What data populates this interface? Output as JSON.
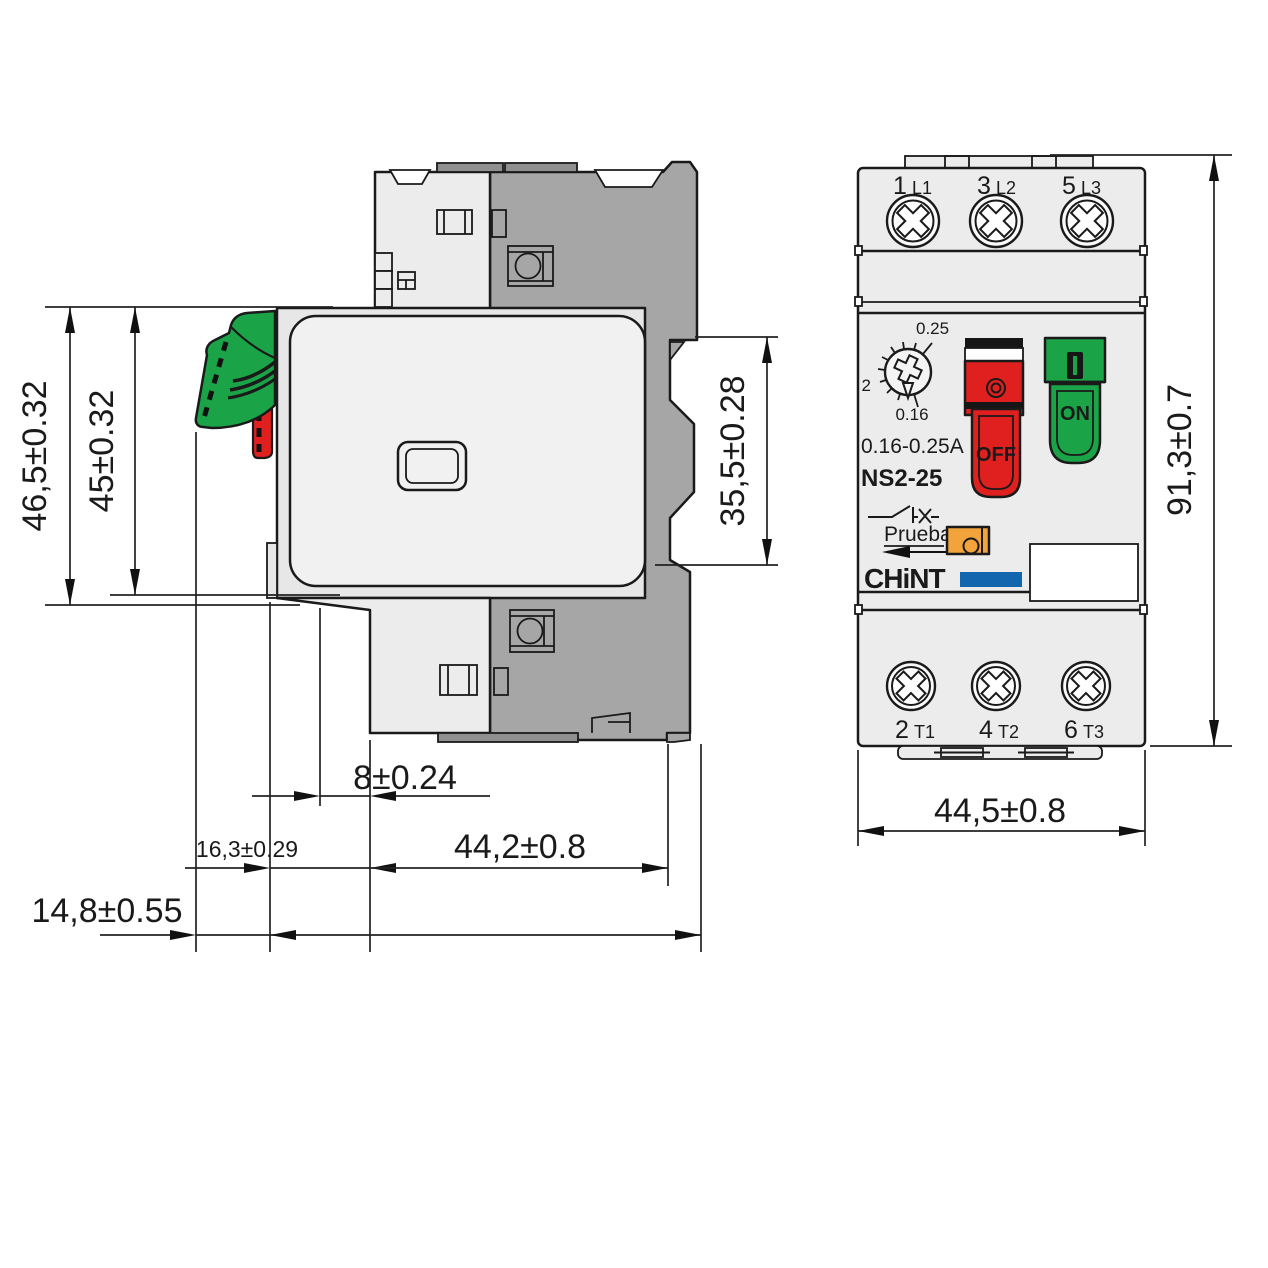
{
  "title": "NS2-25 motor starter dimensional drawing",
  "side_view": {
    "dim_height_outer": "46,5±0.32",
    "dim_height_inner": "45±0.32",
    "dim_rail_cutout": "35,5±0.28",
    "dim_step": "8±0.24",
    "dim_lever": "16,3±0.29",
    "dim_body_depth": "44,2±0.8",
    "dim_lever_offset": "14,8±0.55"
  },
  "front_view": {
    "dim_height": "91,3±0.7",
    "dim_width": "44,5±0.8",
    "terminals_top": [
      {
        "num": "1",
        "label": "L1"
      },
      {
        "num": "3",
        "label": "L2"
      },
      {
        "num": "5",
        "label": "L3"
      }
    ],
    "terminals_bottom": [
      {
        "num": "2",
        "label": "T1"
      },
      {
        "num": "4",
        "label": "T2"
      },
      {
        "num": "6",
        "label": "T3"
      }
    ],
    "dial": {
      "max": "0.25",
      "mid": "2",
      "min": "0.16"
    },
    "rating": "0.16-0.25A",
    "model": "NS2-25",
    "test_label": "Prueba",
    "brand": "CHiNT",
    "off_label": "OFF",
    "on_label": "ON"
  },
  "colors": {
    "green": "#1aa347",
    "red": "#e01f1f",
    "orange": "#f2a33c",
    "blue": "#1266ae",
    "body_light": "#ececec",
    "body_lighter": "#f1f1f1",
    "body_plate": "#e7e7e7",
    "body_dark": "#a6a6a6",
    "body_darker": "#8f8f8f",
    "line": "#1a1a1a"
  }
}
